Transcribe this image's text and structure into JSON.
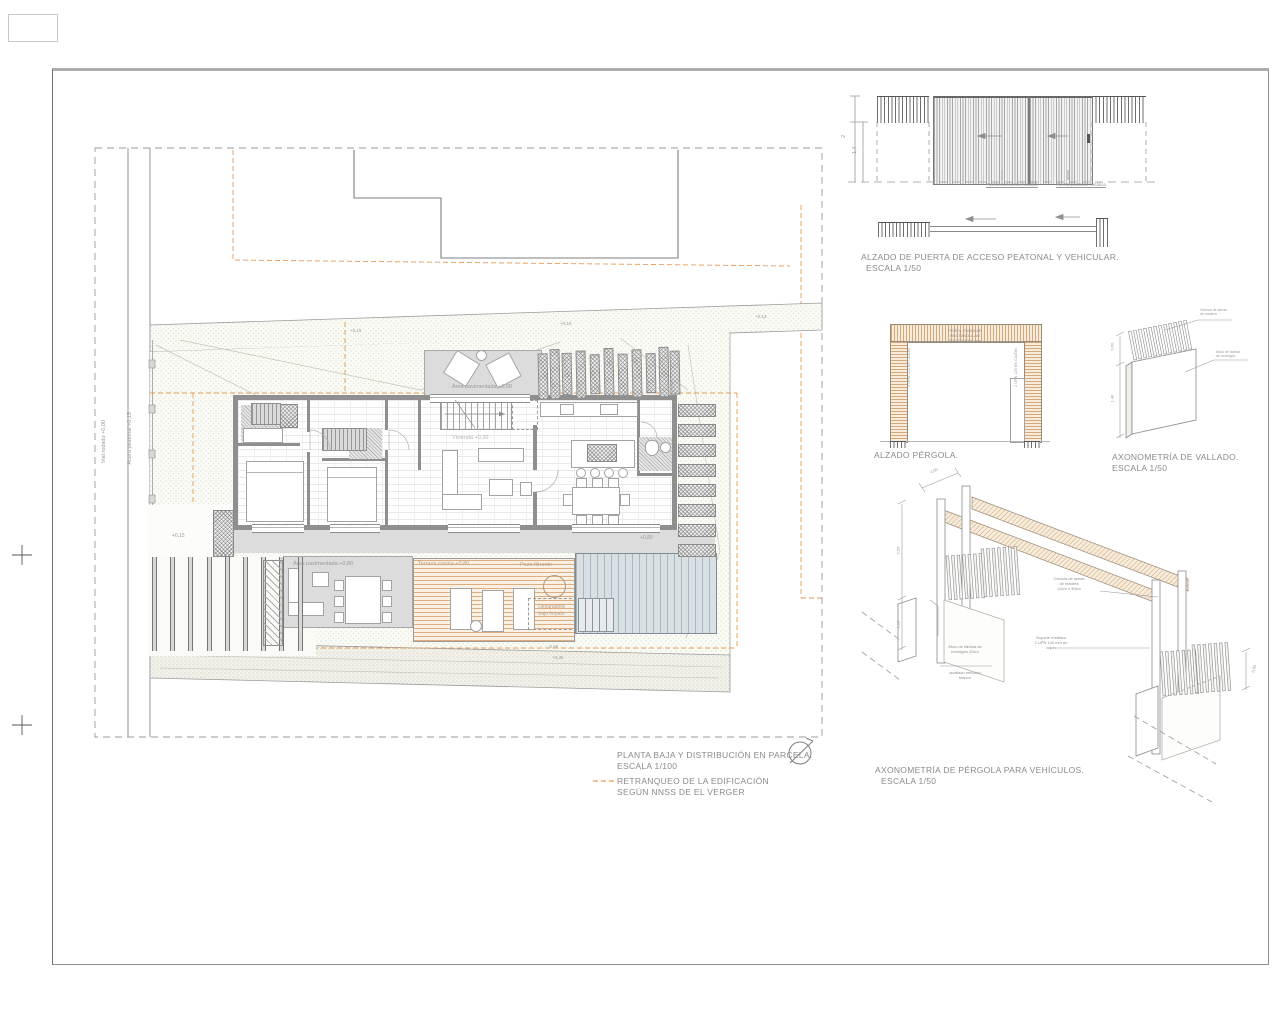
{
  "colors": {
    "orange": "#e59a55",
    "wall_gray": "#8f8f8f",
    "terrace_gray": "#dcdcdc",
    "deck_tan": "#dcae82",
    "pool_blue": "#d9e0e4",
    "beam_tan": "#d4a87a"
  },
  "legend": {
    "title": "PLANTA BAJA Y DISTRIBUCIÓN EN PARCELA.",
    "scale": "ESCALA 1/100",
    "retranqueo_1": "RETRANQUEO DE LA EDIFICACIÓN",
    "retranqueo_2": "SEGÚN NNSS DE EL VERGER"
  },
  "plan": {
    "street_v1": "Vial rodado +0,00",
    "street_v2": "Acera peatonal +0,15",
    "area_pav_top": "Área pavimentada +0,00",
    "area_pav_lower": "Área pavimentada +0,80",
    "terraza": "Terraza cocina +0,80",
    "pozo": "Pozo filtrante",
    "depuradora_1": "Depuradora",
    "depuradora_2": "bajo forjado",
    "vivienda": "Vivienda +0,30",
    "pool_level": "+0,80",
    "carport_level": "+0,15",
    "street_levels": [
      "+0,15",
      "+0,19",
      "+0,13"
    ],
    "bottom_levels": [
      "-0,60",
      "+0,45"
    ]
  },
  "gate": {
    "title": "ALZADO DE PUERTA DE ACCESO PEATONAL Y VEHICULAR.",
    "scale": "ESCALA 1/50",
    "dim_total": "2",
    "dim_leaf": "1,4",
    "label_sliding": "Puerta corredera metálica",
    "label_pedestrian": "Puerta peatonal metálica"
  },
  "pergola_elev": {
    "title": "ALZADO PÉRGOLA.",
    "note_1": "PERFIL TUBULAR",
    "note_2": "RECTANGULAR",
    "note_3": "80x120x4000 mm",
    "column_note": "2 UPN 120 EN CAJÓN"
  },
  "vallado": {
    "title": "AXONOMETRÍA DE VALLADO.",
    "scale": "ESCALA 1/50",
    "label_top_1": "Celosía de lamas",
    "label_top_2": "de madera",
    "label_right_1": "Muro de fábrica",
    "label_right_2": "de hormigón",
    "dim_upper": "0,60",
    "dim_lower": "1,40"
  },
  "pergola_axon": {
    "title": "AXONOMETRÍA DE PÉRGOLA PARA VEHÍCULOS.",
    "scale": "ESCALA 1/50",
    "celosia_1": "Celosía de lamas",
    "celosia_2": "de madera",
    "celosia_3": "12cm x 30cm",
    "soporte_1": "Soporte metálico",
    "soporte_2": "2 UPN 140 mm en",
    "soporte_3": "cajón",
    "muro_1": "Muro de fábrica de",
    "muro_2": "hormigón 20cm",
    "muro_3": "acabado enlucido",
    "muro_4": "blanco",
    "dim_span": "4,00",
    "dim_h1": "2,50",
    "dim_h2": "1,10",
    "dim_r": "0,60"
  }
}
